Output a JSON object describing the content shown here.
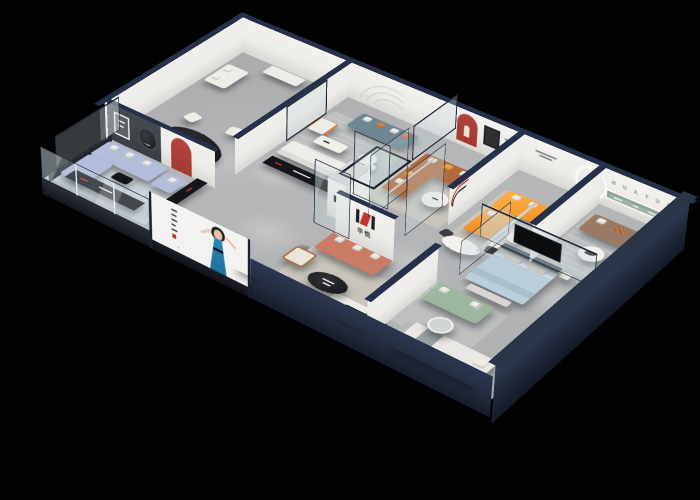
{
  "meta": {
    "description": "3D isometric cutaway render of a HuaYue furniture showroom floor plan",
    "view": "isometric cutaway from above",
    "background": "black"
  },
  "brand": {
    "logo_cn": "华悦",
    "logo_latin": "H U A Y U E"
  },
  "palette": {
    "navy": "#26304a",
    "navy-deep": "#1b2333",
    "navy-wall": "#232c3e",
    "wall-white": "#ecebe7",
    "wall-shade": "#d9d8d4",
    "charcoal": "#3b3f45",
    "floor": "#b5b7b9",
    "glass": "rgba(203,219,228,0.32)",
    "glass-frame": "#1d2533",
    "red-accent": "#a23a30",
    "logo-red": "#c5342c",
    "logo-black": "#1d1f22",
    "white-fur": "#eeece7",
    "black-fur": "#141619",
    "sofa-periwinkle": "#b3bcd9",
    "sofa-teal": "#6d8893",
    "sofa-caramel": "#b06a3e",
    "sofa-orange": "#f08a1d",
    "sofa-coral": "#c97c63",
    "sofa-brown": "#997a64",
    "sofa-sage": "#9cb6a0",
    "bed-blue": "#b9cfda",
    "bed-head": "#49525c",
    "pillow-orange": "#d97d4a",
    "pillow-yellow": "#f0a53c",
    "rug-gray": "#bdbfc0",
    "rug-blue": "#ccd3da",
    "rug-warm": "#c8c4bc",
    "green-tree": "#5f7f46",
    "green-cactus": "#4d7a4e",
    "green-shelf": "#9db5a6",
    "bear": "#a4543c",
    "skin": "#efc1a6",
    "hair": "#1c1c1e",
    "dress": "#1e6f9d",
    "stool-blue": "#9fb0bc",
    "poster": "#f2f2f0",
    "text-gray": "#7d848a"
  },
  "rooms": [
    {
      "id": "dining-display",
      "name": "Dining display room",
      "items": [
        "black oval dining table",
        "4 white chairs",
        "white loveseat",
        "white sideboard",
        "floor lamp",
        "red arched niche",
        "dark gallery wall with round artwork"
      ]
    },
    {
      "id": "media-lounge",
      "name": "Periwinkle sofa media room",
      "items": [
        "periwinkle sectional sofa",
        "black media consoles with red accents",
        "pale blue rug",
        "glass facade"
      ]
    },
    {
      "id": "lounge",
      "name": "Lounge display",
      "items": [
        "teal three-seat sofa",
        "orange and white pillows",
        "potted tree",
        "white armchair with orange trim",
        "white sofa",
        "white coffee table",
        "round nesting tables",
        "black media console",
        "striped rug",
        "arc grooves wall decor"
      ]
    },
    {
      "id": "caramel-room",
      "name": "Glass-walled caramel sofa room",
      "items": [
        "caramel leather corner sofa",
        "yellow and white pillows",
        "round white coffee table",
        "red arched niche",
        "dark framed artwork",
        "glass door"
      ]
    },
    {
      "id": "orange-room",
      "name": "Orange sofa showroom",
      "items": [
        "bright orange corner sofa",
        "white pillows",
        "round side table",
        "metal figure sculpture with illuminated wall ring",
        "white oval table with two wire chairs",
        "arc floor lamp"
      ]
    },
    {
      "id": "huayue-room",
      "name": "HUAYUE brand room",
      "items": [
        "brown fabric sofa",
        "patterned center cushion",
        "green recessed display shelf",
        "HUAYUE wall letters",
        "round coffee table with black decor",
        "striped rug"
      ]
    },
    {
      "id": "bedroom-display",
      "name": "Bedroom display behind glass",
      "items": [
        "light blue bed with white pillows",
        "wall TV on glass partition",
        "white bench",
        "sage green sofa",
        "round glass table with plant",
        "white corner bed with gray throw"
      ]
    },
    {
      "id": "brand-room",
      "name": "Brand logo room",
      "items": [
        "coral sofa with white pillows",
        "HuaYue logo wall",
        "black oval coffee table",
        "white ottoman",
        "cream armchair",
        "black media shelf with red branding",
        "blue-gray cube stool"
      ]
    },
    {
      "id": "atrium",
      "name": "Central glass plant atrium",
      "items": [
        "tall glass column with cacti and plants",
        "white pedestal",
        "teddy bear mascot sculpture with tray",
        "white column with navy sign"
      ]
    }
  ],
  "billboard": {
    "description": "Illustrated woman in a blue dress on a white poster panel",
    "text_orientation": "vertical"
  }
}
